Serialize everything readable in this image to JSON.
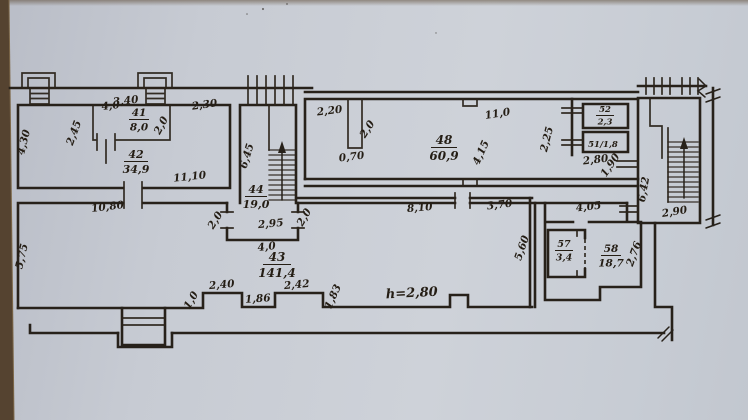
{
  "meta": {
    "drawing_type": "hand-drawn floor plan",
    "paper_color": "#c7cbd3",
    "edge_color": "#554330",
    "ink_color": "#27211a"
  },
  "rooms": [
    {
      "number": "41",
      "area": "8,0",
      "x": 139,
      "y": 116,
      "size": 10.5,
      "bar": 20
    },
    {
      "number": "42",
      "area": "34,9",
      "x": 136,
      "y": 158,
      "size": 11,
      "bar": 24
    },
    {
      "number": "43",
      "area": "141,4",
      "x": 277,
      "y": 261,
      "size": 12,
      "bar": 28
    },
    {
      "number": "44",
      "area": "19,0",
      "x": 256,
      "y": 193,
      "size": 11,
      "bar": 22
    },
    {
      "number": "48",
      "area": "60,9",
      "x": 444,
      "y": 144,
      "size": 12,
      "bar": 26
    },
    {
      "number": "52",
      "area": "2,3",
      "x": 605,
      "y": 112,
      "size": 8.5,
      "bar": 18
    },
    {
      "number": "57",
      "area": "3,4",
      "x": 564,
      "y": 247,
      "size": 9.5,
      "bar": 18
    },
    {
      "number": "58",
      "area": "18,7",
      "x": 611,
      "y": 252,
      "size": 10.5,
      "bar": 20
    }
  ],
  "inline_rooms": [
    {
      "label": "51/1,8",
      "x": 603,
      "y": 147,
      "size": 8.5
    }
  ],
  "dimensions": [
    {
      "text": "3,40",
      "x": 126,
      "y": 104,
      "rot": -6
    },
    {
      "text": "4,30",
      "x": 27,
      "y": 143,
      "rot": -76
    },
    {
      "text": "2,45",
      "x": 77,
      "y": 134,
      "rot": -70
    },
    {
      "text": "4,0",
      "x": 111,
      "y": 109,
      "rot": -6
    },
    {
      "text": "2,0",
      "x": 164,
      "y": 127,
      "rot": -62
    },
    {
      "text": "2,30",
      "x": 205,
      "y": 108,
      "rot": -8
    },
    {
      "text": "11,10",
      "x": 190,
      "y": 180,
      "rot": -6
    },
    {
      "text": "10,80",
      "x": 108,
      "y": 210,
      "rot": -7
    },
    {
      "text": "5,75",
      "x": 25,
      "y": 257,
      "rot": -77
    },
    {
      "text": "6,45",
      "x": 250,
      "y": 157,
      "rot": -73
    },
    {
      "text": "2,0",
      "x": 218,
      "y": 222,
      "rot": -58
    },
    {
      "text": "2,95",
      "x": 271,
      "y": 227,
      "rot": -5
    },
    {
      "text": "2,0",
      "x": 307,
      "y": 219,
      "rot": -60
    },
    {
      "text": "4,0",
      "x": 267,
      "y": 250,
      "rot": -6
    },
    {
      "text": "2,20",
      "x": 330,
      "y": 114,
      "rot": -7
    },
    {
      "text": "2,0",
      "x": 370,
      "y": 131,
      "rot": -57
    },
    {
      "text": "0,70",
      "x": 352,
      "y": 160,
      "rot": -7
    },
    {
      "text": "11,0",
      "x": 498,
      "y": 117,
      "rot": -9
    },
    {
      "text": "4,15",
      "x": 484,
      "y": 154,
      "rot": -66
    },
    {
      "text": "2,25",
      "x": 550,
      "y": 140,
      "rot": -76
    },
    {
      "text": "2,80",
      "x": 596,
      "y": 163,
      "rot": -7
    },
    {
      "text": "1,90",
      "x": 613,
      "y": 167,
      "rot": -56
    },
    {
      "text": "6,42",
      "x": 647,
      "y": 190,
      "rot": -80
    },
    {
      "text": "2,90",
      "x": 675,
      "y": 215,
      "rot": -9
    },
    {
      "text": "8,10",
      "x": 420,
      "y": 211,
      "rot": -5
    },
    {
      "text": "3,70",
      "x": 500,
      "y": 208,
      "rot": -7
    },
    {
      "text": "5,60",
      "x": 525,
      "y": 249,
      "rot": -71
    },
    {
      "text": "4,05",
      "x": 589,
      "y": 210,
      "rot": -7
    },
    {
      "text": "2,76",
      "x": 637,
      "y": 255,
      "rot": -70
    },
    {
      "text": "1,0",
      "x": 194,
      "y": 302,
      "rot": -60
    },
    {
      "text": "2,40",
      "x": 222,
      "y": 288,
      "rot": -5
    },
    {
      "text": "1,86",
      "x": 258,
      "y": 302,
      "rot": -4
    },
    {
      "text": "2,42",
      "x": 297,
      "y": 288,
      "rot": -5
    },
    {
      "text": "1,83",
      "x": 336,
      "y": 298,
      "rot": -66
    },
    {
      "text": "h=2,80",
      "x": 412,
      "y": 297,
      "rot": -3,
      "size": 13
    }
  ]
}
